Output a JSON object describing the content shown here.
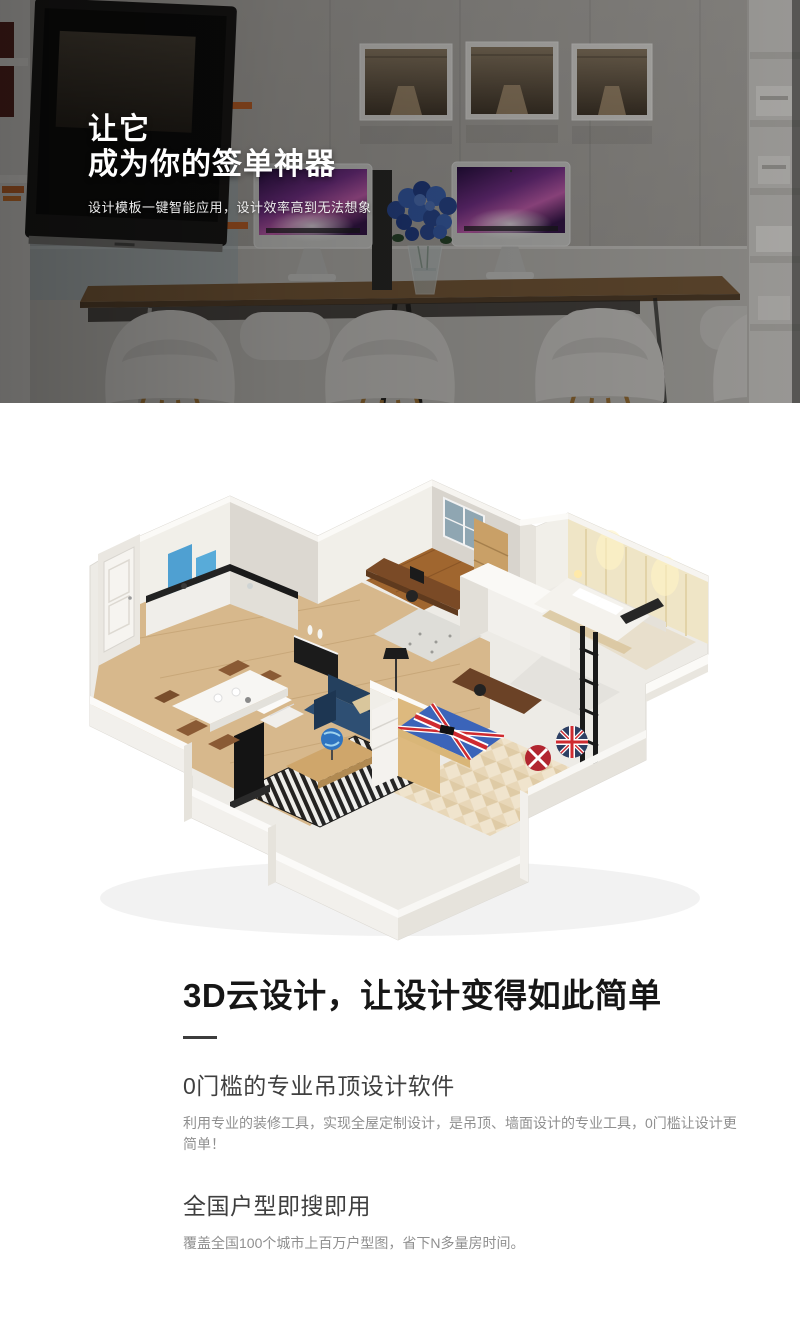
{
  "hero": {
    "title_line1": "让它",
    "title_line2": "成为你的签单神器",
    "subtitle": "设计模板一键智能应用，设计效率高到无法想象"
  },
  "intro": {
    "heading": "3D云设计，让设计变得如此简单"
  },
  "features": [
    {
      "title": "0门槛的专业吊顶设计软件",
      "desc": "利用专业的装修工具，实现全屋定制设计，是吊顶、墙面设计的专业工具，0门槛让设计更简单！"
    },
    {
      "title": "全国户型即搜即用",
      "desc": "覆盖全国100个城市上百万户型图，省下N多量房时间。"
    }
  ],
  "illustrations": {
    "hero_photo": "office-showroom-with-two-imacs-and-wall-tv",
    "floorplan": "3d-isometric-apartment-rendering"
  },
  "colors": {
    "heading_text": "#161616",
    "feature_title_text": "#3f3f3f",
    "body_text": "#8f8f8f",
    "hero_text": "#ffffff",
    "sofa_navy": "#2e4f73",
    "cabinet_blue": "#4fa0d2",
    "union_jack_blue": "#3b64b9",
    "union_jack_red": "#cf2b30"
  }
}
